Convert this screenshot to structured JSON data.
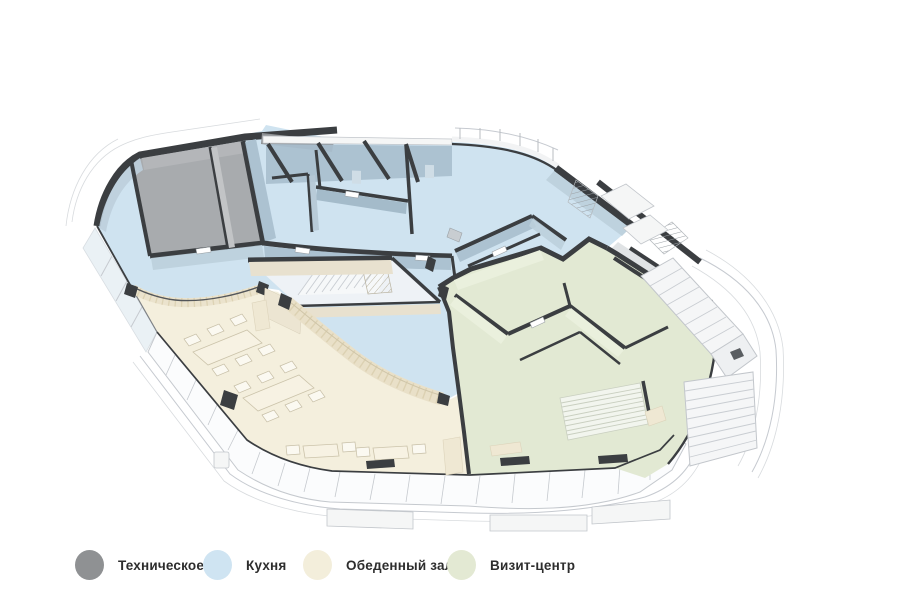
{
  "legend": {
    "items": [
      {
        "id": "technical",
        "label": "Техническое",
        "color": "#8f9193"
      },
      {
        "id": "kitchen",
        "label": "Кухня",
        "color": "#cfe4f2"
      },
      {
        "id": "dining",
        "label": "Обеденный зал",
        "color": "#f3eedb"
      },
      {
        "id": "visit",
        "label": "Визит-центр",
        "color": "#e3e9d3"
      }
    ]
  },
  "zones": {
    "technical_floor": "#a8abae",
    "kitchen_floor": "#cfe3f0",
    "dining_floor": "#f4efdd",
    "visit_floor": "#e2e9d3",
    "wall_color": "#3b3e41"
  }
}
